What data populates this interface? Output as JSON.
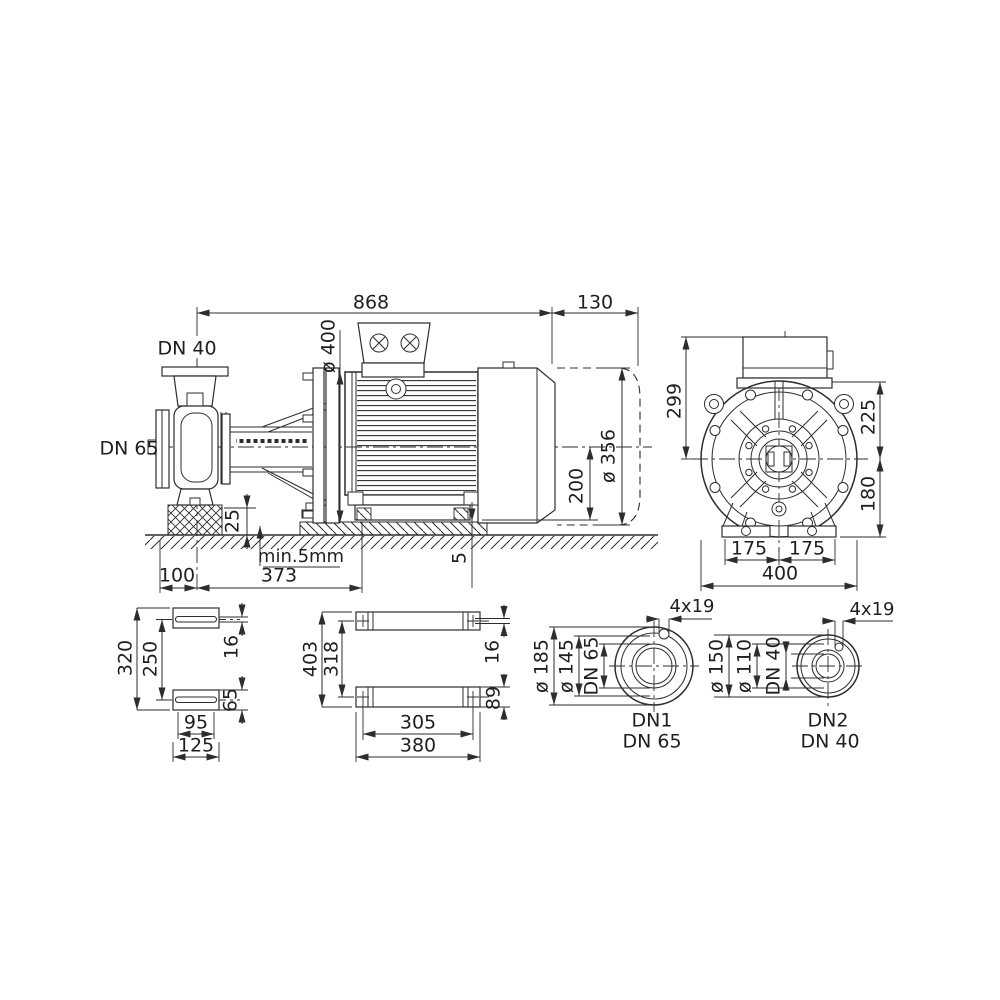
{
  "side_view": {
    "total_length": "868",
    "fan_clearance": "130",
    "motor_flange_dia": "ø 400",
    "discharge_label": "DN 40",
    "suction_label": "DN 65",
    "motor_dia": "ø 356",
    "shaft_height": "200",
    "foundation_height": "25",
    "grout_note": "min.5mm",
    "foot_offset": "100",
    "foot_span": "373",
    "shim": "5"
  },
  "front_view": {
    "box_top_to_center": "299",
    "top_to_center": "225",
    "center_to_bottom": "180",
    "foot_left": "175",
    "foot_right": "175",
    "total_width": "400"
  },
  "pump_foot_plan": {
    "overall_length": "320",
    "hole_spacing": "250",
    "slot_width": "16",
    "foot_width": "65",
    "hole_spacing_x": "95",
    "overall_width": "125"
  },
  "motor_foot_plan": {
    "overall_length": "403",
    "hole_spacing": "318",
    "slot_width": "16",
    "foot_width": "89",
    "hole_spacing_x": "305",
    "overall_width": "380"
  },
  "suction_flange": {
    "bolt_holes": "4x19",
    "outer_dia": "ø 185",
    "bolt_circle": "ø 145",
    "nominal_dia": "DN 65",
    "port_label": "DN1",
    "port_size": "DN 65"
  },
  "discharge_flange": {
    "bolt_holes": "4x19",
    "outer_dia": "ø 150",
    "bolt_circle": "ø 110",
    "nominal_dia": "DN 40",
    "port_label": "DN2",
    "port_size": "DN 40"
  },
  "colors": {
    "line": "#2d2d2d",
    "background": "#ffffff"
  }
}
